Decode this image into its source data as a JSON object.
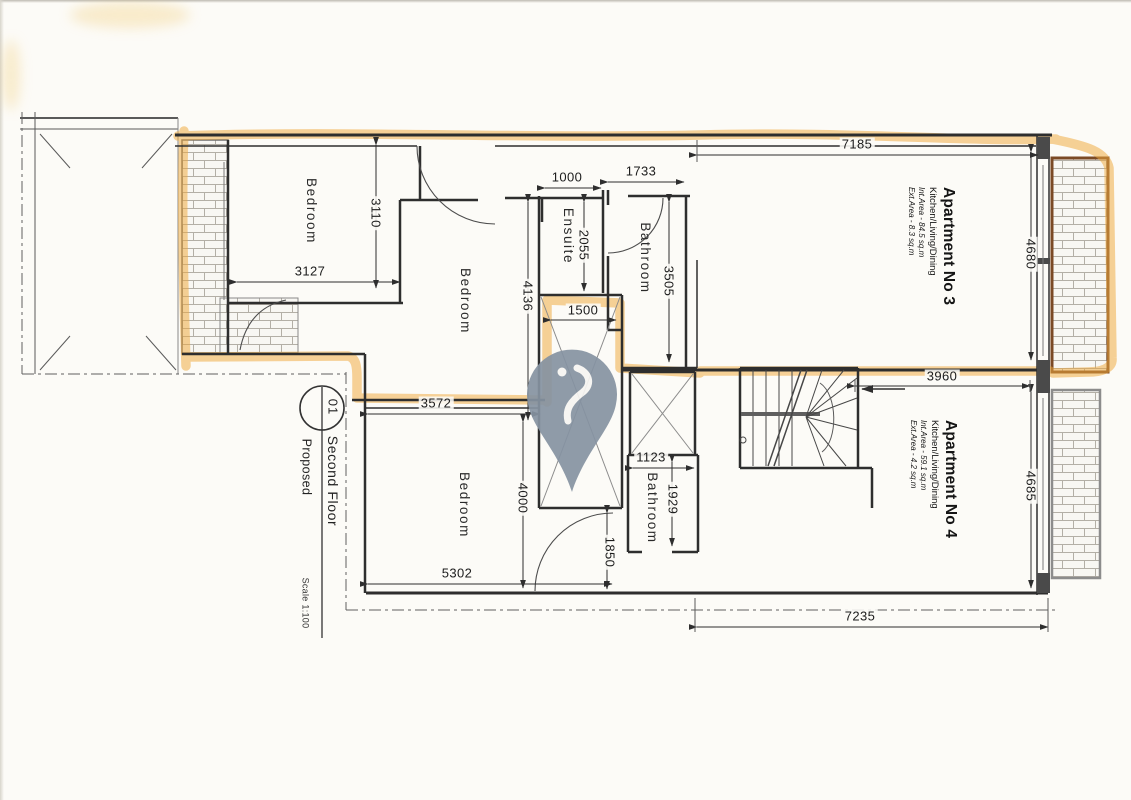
{
  "title_block": {
    "detail_number": "01",
    "title": "Second Floor",
    "status": "Proposed",
    "scale": "Scale 1:100"
  },
  "apartments": [
    {
      "name": "Apartment No 3",
      "use": "Kitchen/Living/Dining",
      "int_area": "Int.Area - 84.5 sq.m",
      "ext_area": "Ext.Area - 8.3 sq.m"
    },
    {
      "name": "Apartment No 4",
      "use": "Kitchen/Living/Dining",
      "int_area": "Int.Area - 59.1 sq.m",
      "ext_area": "Ext.Area - 4.2 sq.m"
    }
  ],
  "rooms": {
    "bedroom_top_left": "Bedroom",
    "bedroom_middle": "Bedroom",
    "bedroom_bottom": "Bedroom",
    "ensuite": "Ensuite",
    "bathroom_top": "Bathroom",
    "bathroom_bottom": "Bathroom"
  },
  "dimensions": {
    "d7185": "7185",
    "d1000": "1000",
    "d1733": "1733",
    "d3110": "3110",
    "d3127": "3127",
    "d2055": "2055",
    "d3505": "3505",
    "d4680": "4680",
    "d4136": "4136",
    "d1500": "1500",
    "d3960": "3960",
    "d3572": "3572",
    "d4685": "4685",
    "d4000": "4000",
    "d1123": "1123",
    "d1929": "1929",
    "d1850": "1850",
    "d5302": "5302",
    "d7235": "7235"
  },
  "icons": {
    "watermark": "location-pin"
  },
  "colors": {
    "highlighter": "#efa93d",
    "pin_grey": "#8693a2",
    "wall_ink": "#2e2e2e",
    "balcony_border_brown": "#7b4a26"
  }
}
